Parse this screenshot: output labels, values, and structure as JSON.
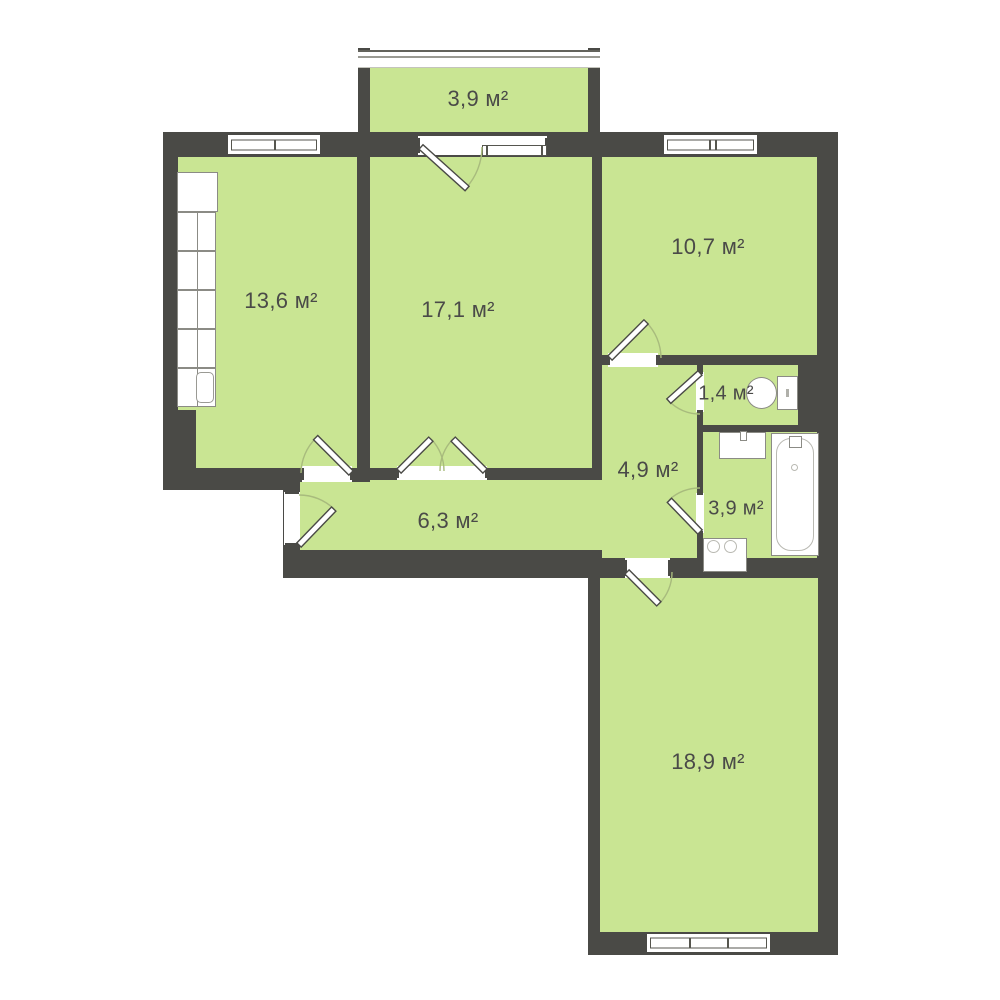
{
  "plan": {
    "type": "apartment-floor-plan",
    "colors": {
      "wall": "#4a4a46",
      "room": "#c9e593",
      "label": "#4a4a48"
    },
    "rooms": [
      {
        "name": "balcony",
        "area_label": "3,9 м²"
      },
      {
        "name": "kitchen",
        "area_label": "13,6 м²"
      },
      {
        "name": "living-room",
        "area_label": "17,1 м²"
      },
      {
        "name": "bedroom-top-right",
        "area_label": "10,7 м²"
      },
      {
        "name": "wc",
        "area_label": "1,4 м²"
      },
      {
        "name": "hallway",
        "area_label": "4,9 м²"
      },
      {
        "name": "bathroom",
        "area_label": "3,9 м²"
      },
      {
        "name": "corridor",
        "area_label": "6,3 м²"
      },
      {
        "name": "bedroom-bottom",
        "area_label": "18,9 м²"
      }
    ],
    "fixtures": [
      "kitchen-cabinets-with-sink",
      "toilet",
      "washbasin",
      "bathtub",
      "washing-machine"
    ]
  }
}
